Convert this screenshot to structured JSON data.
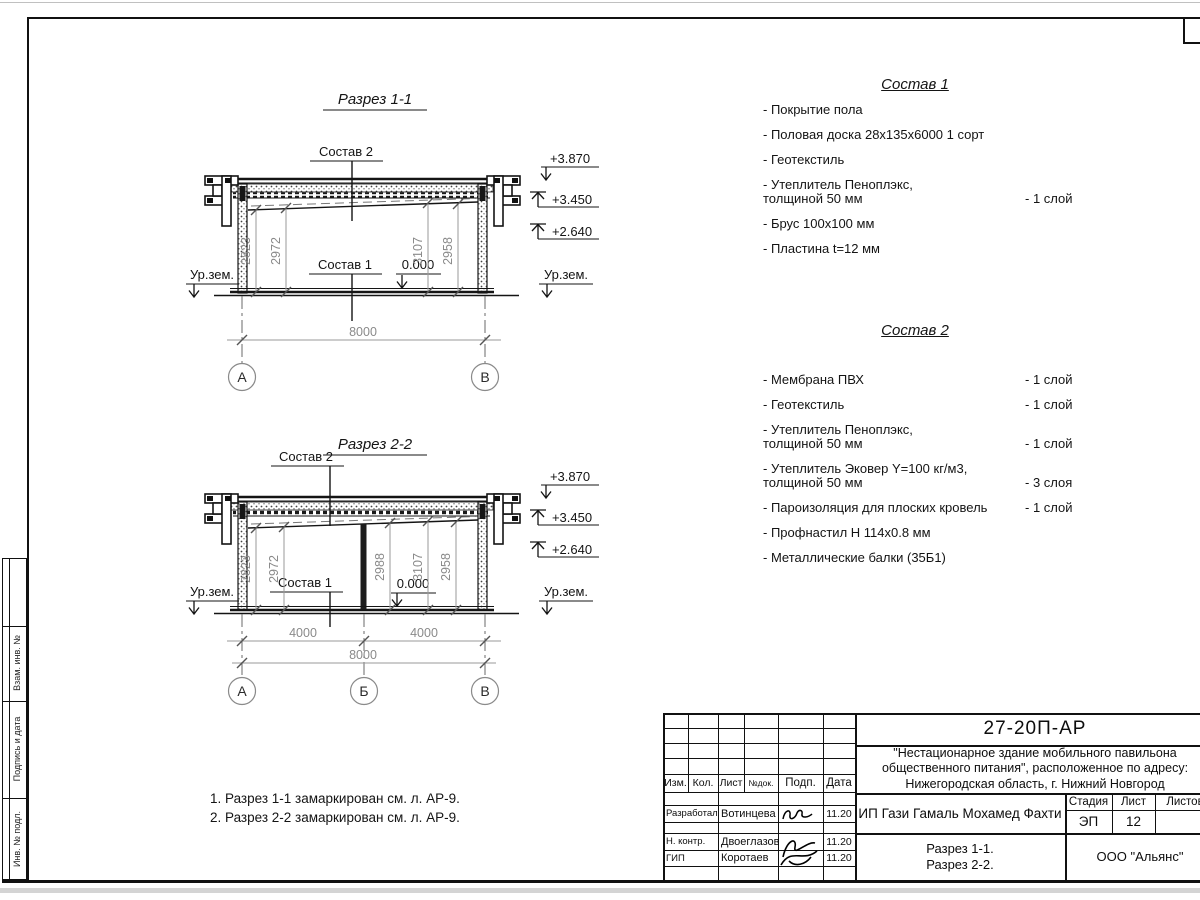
{
  "side_stamp": {
    "labels": [
      "Взам. инв. №",
      "Подпись и дата",
      "Инв. № подл."
    ]
  },
  "drawing": {
    "s1": {
      "title": "Разрез 1-1",
      "sostav2": "Состав 2",
      "sostav1": "Состав 1",
      "zero": "0.000",
      "ground_left": "Ур.зем.",
      "ground_right": "Ур.зем.",
      "elev": [
        "+3.870",
        "+3.450",
        "+2.640"
      ],
      "dims": [
        "2823",
        "2972",
        "3107",
        "2958"
      ],
      "total": "8000",
      "axes": [
        "А",
        "В"
      ]
    },
    "s2": {
      "title": "Разрез 2-2",
      "sostav2": "Состав 2",
      "sostav1": "Состав 1",
      "zero": "0.000",
      "ground_left": "Ур.зем.",
      "ground_right": "Ур.зем.",
      "elev": [
        "+3.870",
        "+3.450",
        "+2.640"
      ],
      "dims": [
        "2823",
        "2972",
        "2988",
        "3107",
        "2958"
      ],
      "spans": [
        "4000",
        "4000"
      ],
      "total": "8000",
      "axes": [
        "А",
        "Б",
        "В"
      ]
    }
  },
  "sostav1": {
    "title": "Состав 1",
    "items": [
      {
        "l1": "- Покрытие пола",
        "l2": "",
        "qty": ""
      },
      {
        "l1": "- Половая доска 28х135х6000 1 сорт",
        "l2": "",
        "qty": ""
      },
      {
        "l1": "- Геотекстиль",
        "l2": "",
        "qty": ""
      },
      {
        "l1": "- Утеплитель Пеноплэкс,",
        "l2": "толщиной 50 мм",
        "qty": "- 1 слой"
      },
      {
        "l1": "- Брус 100х100 мм",
        "l2": "",
        "qty": ""
      },
      {
        "l1": "- Пластина t=12 мм",
        "l2": "",
        "qty": ""
      }
    ]
  },
  "sostav2": {
    "title": "Состав 2",
    "items": [
      {
        "l1": "- Мембрана ПВХ",
        "l2": "",
        "qty": "- 1 слой"
      },
      {
        "l1": "- Геотекстиль",
        "l2": "",
        "qty": "- 1 слой"
      },
      {
        "l1": "- Утеплитель Пеноплэкс,",
        "l2": "толщиной 50 мм",
        "qty": "- 1 слой"
      },
      {
        "l1": "- Утеплитель Эковер Y=100 кг/м3,",
        "l2": "толщиной 50 мм",
        "qty": "- 3 слоя"
      },
      {
        "l1": "- Пароизоляция для плоских кровель",
        "l2": "",
        "qty": "- 1 слой"
      },
      {
        "l1": "- Профнастил Н 114х0.8 мм",
        "l2": "",
        "qty": ""
      },
      {
        "l1": "- Металлические балки (35Б1)",
        "l2": "",
        "qty": ""
      }
    ]
  },
  "notes": {
    "line1": "1. Разрез 1-1 замаркирован см. л. АР-9.",
    "line2": "2. Разрез 2-2 замаркирован см. л. АР-9."
  },
  "titleblock": {
    "doc_number": "27-20П-АР",
    "project_title": "\"Нестационарное здание мобильного павильона общественного питания\", расположенное по адресу: Нижегородская область, г. Нижний Новгород",
    "cols": {
      "izm": "Изм.",
      "kol": "Кол.",
      "list": "Лист",
      "ndok": "№док.",
      "podp": "Подп.",
      "data": "Дата"
    },
    "rows": [
      {
        "role": "Разработал",
        "name": "Вотинцева",
        "date": "11.20"
      },
      {
        "role": "Н. контр.",
        "name": "Двоеглазов",
        "date": "11.20"
      },
      {
        "role": "ГИП",
        "name": "Коротаев",
        "date": "11.20"
      }
    ],
    "client": "ИП Гази Гамаль Мохамед Фахти",
    "stage_label": "Стадия",
    "sheet_label": "Лист",
    "sheets_label": "Листов",
    "stage": "ЭП",
    "sheet": "12",
    "sheets": "",
    "drawing_name1": "Разрез 1-1.",
    "drawing_name2": "Разрез 2-2.",
    "company": "ООО \"Альянс\""
  }
}
